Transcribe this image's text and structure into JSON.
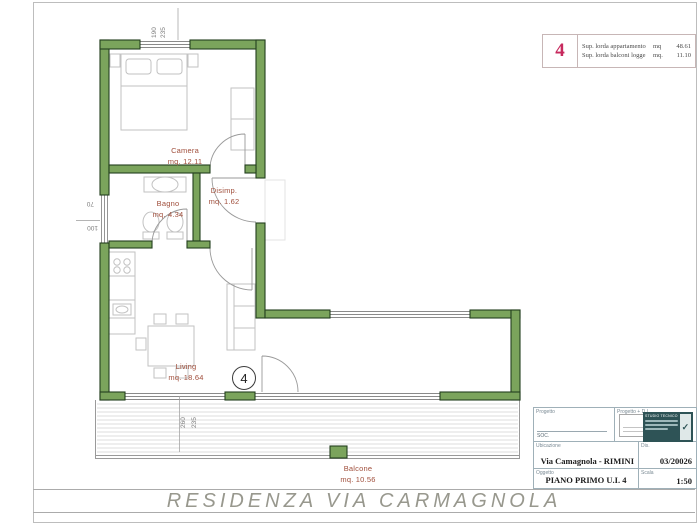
{
  "colors": {
    "wall_fill": "#7ba45c",
    "wall_stroke": "#243f1e",
    "room_label": "#a04f3c",
    "accent_magenta": "#c72a5e",
    "footer_gray": "#98988e"
  },
  "summary_box": {
    "unit_number": "4",
    "rows": [
      {
        "label": "Sup. lorda appartamento",
        "unit": "mq",
        "value": "48.61"
      },
      {
        "label": "Sup. lorda balconi logge",
        "unit": "mq.",
        "value": "11.10"
      }
    ]
  },
  "plan": {
    "rooms": [
      {
        "name": "Camera",
        "area": "mq. 12.11"
      },
      {
        "name": "Bagno",
        "area": "mq. 4.34"
      },
      {
        "name": "Disimp.",
        "area": "mq. 1.62"
      },
      {
        "name": "Living",
        "area": "mq. 18.64"
      },
      {
        "name": "Balcone",
        "area": "mq. 10.56"
      }
    ],
    "unit_marker": "4",
    "dimensions": {
      "top_a": "190",
      "top_b": "235",
      "left_a": "70",
      "left_b": "100",
      "bottom_a": "260",
      "bottom_b": "235"
    }
  },
  "title_block": {
    "progetto_label": "Progetto",
    "progetto_note": "SOC.",
    "progetto_dl_label": "Progetto + D.L.",
    "studio_name": "STUDIO TECNICO",
    "ubicazione_label": "Ubicazione",
    "ubicazione_value": "Via Camagnola - RIMINI",
    "dis_label": "Dis.",
    "dis_value": "03/20026",
    "oggetto_label": "Oggetto",
    "oggetto_value": "PIANO PRIMO U.I. 4",
    "scala_label": "Scala",
    "scala_value": "1:50"
  },
  "icons": {
    "studio_logo_check": "✓"
  },
  "footer": {
    "title": "RESIDENZA VIA CARMAGNOLA"
  }
}
